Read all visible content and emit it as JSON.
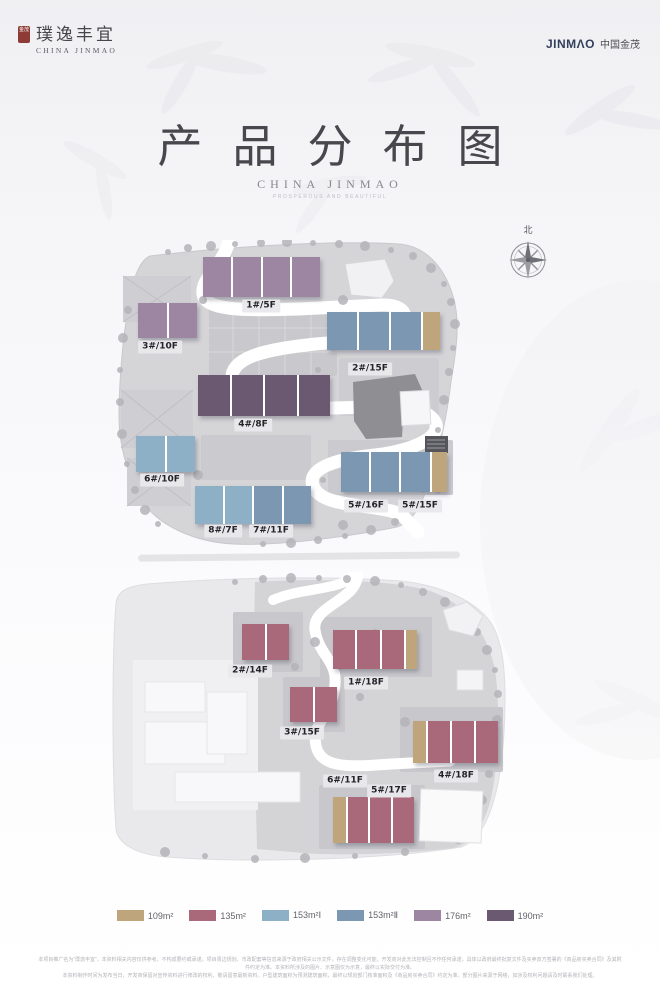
{
  "header": {
    "left_brand": {
      "seal_text": "金茂",
      "name": "璞逸丰宜",
      "subtitle": "CHINA JINMAO"
    },
    "right_brand": {
      "logo": "JINMΛO",
      "cn": "中国金茂"
    }
  },
  "title": {
    "text": "产品分布图",
    "subtitle": "CHINA JINMAO",
    "tagline": "PROSPEROUS AND BEAUTIFUL"
  },
  "compass": {
    "label": "北"
  },
  "palette": {
    "109": "#bfa57c",
    "135": "#a9697b",
    "153a": "#8db0c6",
    "153b": "#7b97b2",
    "176": "#9d86a2",
    "190": "#6a5970"
  },
  "maps": [
    {
      "name": "north-plot",
      "buildings": [
        {
          "x": 90,
          "y": 17,
          "w": 117,
          "h": 40,
          "segs": [
            {
              "c": "176"
            },
            {
              "c": "176"
            },
            {
              "c": "176"
            },
            {
              "c": "176"
            }
          ]
        },
        {
          "x": 25,
          "y": 63,
          "w": 59,
          "h": 35,
          "segs": [
            {
              "c": "176"
            },
            {
              "c": "176"
            }
          ]
        },
        {
          "x": 214,
          "y": 72,
          "w": 113,
          "h": 38,
          "segs": [
            {
              "c": "153b"
            },
            {
              "c": "153b"
            },
            {
              "c": "153b"
            },
            {
              "c": "109",
              "f": 0.55
            }
          ]
        },
        {
          "x": 85,
          "y": 135,
          "w": 132,
          "h": 41,
          "segs": [
            {
              "c": "190"
            },
            {
              "c": "190"
            },
            {
              "c": "190"
            },
            {
              "c": "190"
            }
          ]
        },
        {
          "x": 23,
          "y": 196,
          "w": 59,
          "h": 36,
          "segs": [
            {
              "c": "153a"
            },
            {
              "c": "153a"
            }
          ]
        },
        {
          "x": 82,
          "y": 246,
          "w": 116,
          "h": 38,
          "segs": [
            {
              "c": "153a"
            },
            {
              "c": "153a"
            },
            {
              "c": "153b"
            },
            {
              "c": "153b"
            }
          ]
        },
        {
          "x": 228,
          "y": 212,
          "w": 106,
          "h": 40,
          "segs": [
            {
              "c": "153b"
            },
            {
              "c": "153b"
            },
            {
              "c": "153b"
            },
            {
              "c": "109",
              "f": 0.55
            }
          ]
        }
      ],
      "labels": [
        {
          "text": "1#/5F",
          "x": 148,
          "y": 66
        },
        {
          "text": "3#/10F",
          "x": 47,
          "y": 107
        },
        {
          "text": "2#/15F",
          "x": 257,
          "y": 129
        },
        {
          "text": "4#/8F",
          "x": 140,
          "y": 185
        },
        {
          "text": "6#/10F",
          "x": 49,
          "y": 240
        },
        {
          "text": "8#/7F",
          "x": 110,
          "y": 291
        },
        {
          "text": "7#/11F",
          "x": 158,
          "y": 291
        },
        {
          "text": "5#/16F",
          "x": 253,
          "y": 266
        },
        {
          "text": "5#/15F",
          "x": 307,
          "y": 266
        }
      ]
    },
    {
      "name": "south-plot",
      "buildings": [
        {
          "x": 137,
          "y": 52,
          "w": 47,
          "h": 36,
          "segs": [
            {
              "c": "135"
            },
            {
              "c": "135"
            }
          ]
        },
        {
          "x": 228,
          "y": 58,
          "w": 84,
          "h": 39,
          "segs": [
            {
              "c": "135"
            },
            {
              "c": "135"
            },
            {
              "c": "135"
            },
            {
              "c": "109",
              "f": 0.5
            }
          ]
        },
        {
          "x": 185,
          "y": 115,
          "w": 47,
          "h": 35,
          "segs": [
            {
              "c": "135"
            },
            {
              "c": "135"
            }
          ]
        },
        {
          "x": 308,
          "y": 149,
          "w": 85,
          "h": 42,
          "segs": [
            {
              "c": "109",
              "f": 0.6
            },
            {
              "c": "135"
            },
            {
              "c": "135"
            },
            {
              "c": "135"
            }
          ]
        },
        {
          "x": 228,
          "y": 225,
          "w": 81,
          "h": 46,
          "segs": [
            {
              "c": "109",
              "f": 0.6
            },
            {
              "c": "135"
            },
            {
              "c": "135"
            },
            {
              "c": "135"
            }
          ]
        }
      ],
      "labels": [
        {
          "text": "2#/14F",
          "x": 145,
          "y": 99
        },
        {
          "text": "1#/18F",
          "x": 261,
          "y": 111
        },
        {
          "text": "3#/15F",
          "x": 197,
          "y": 161
        },
        {
          "text": "4#/18F",
          "x": 351,
          "y": 204
        },
        {
          "text": "6#/11F",
          "x": 240,
          "y": 209
        },
        {
          "text": "5#/17F",
          "x": 284,
          "y": 219
        }
      ]
    }
  ],
  "legend": [
    {
      "label": "109m²",
      "key": "109"
    },
    {
      "label": "135m²",
      "key": "135"
    },
    {
      "label": "153m²Ⅰ",
      "key": "153a"
    },
    {
      "label": "153m²Ⅱ",
      "key": "153b"
    },
    {
      "label": "176m²",
      "key": "176"
    },
    {
      "label": "190m²",
      "key": "190"
    }
  ],
  "disclaimer": {
    "line1": "本项目推广名为“璞逸丰宜”，本资料相关内容仅供参考，不构成要约或承诺。项目周边规划、市政配套等信息来源于政府相关公示文件，存在调整变化可能，开发商对此无法控制且不作任何承诺，具体以政府最终批复文件及买卖双方签署的《商品房买卖合同》及其附件约定为准。本资料所涉及的图片、示意图仅为示意，最终以实际交付为准。",
    "line2": "本资料制作时间为发布当日，开发商保留对宣传资料进行修改的权利，敬请留意最新资料。户型建筑面积为预测建筑面积，最终以规划部门核准面积及《商品房买卖合同》约定为准。部分图片来源于网络，如涉及权利问题请及时联系我们处理。"
  }
}
